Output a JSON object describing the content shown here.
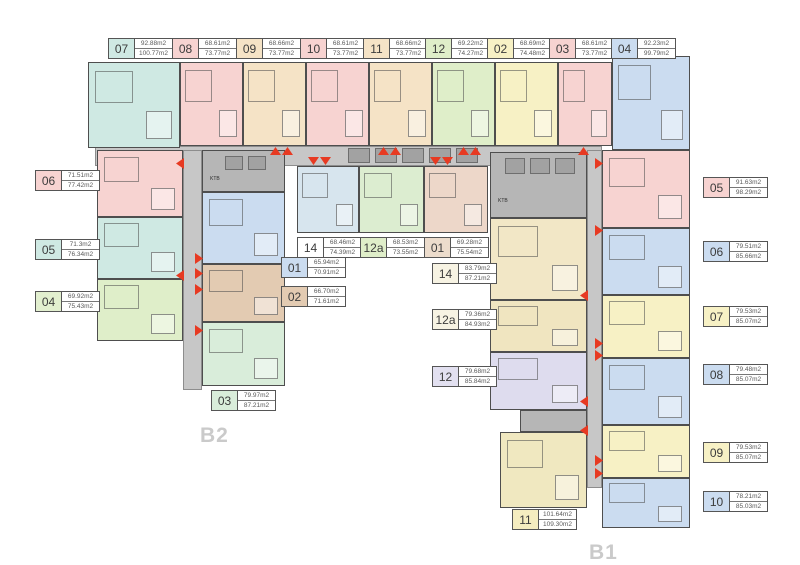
{
  "colors": {
    "teal": "#cfe9e3",
    "pink": "#f7d3d1",
    "tan": "#f5e3c6",
    "green": "#dfeec9",
    "yellow": "#f7f1c5",
    "blue": "#cbdcf0",
    "mint": "#d9edda",
    "lightblue": "#d7e5ee",
    "mintgreen": "#dcedd0",
    "cream": "#f2e7c6",
    "cream2": "#f0e5c0",
    "lavender": "#dedcee",
    "browntan": "#e3cbb2",
    "rosetan": "#edd7c9",
    "yellowtan": "#f0e8c0",
    "corridor": "#c7c7c7",
    "utility": "#b6b6b6",
    "red": "#e73a22"
  },
  "buildings": {
    "left": "B2",
    "right": "B1"
  },
  "utility_label": "KTB",
  "top_labels": [
    {
      "num": "07",
      "area1": "92.88m2",
      "area2": "100.77m2",
      "color": "#cfe9e3"
    },
    {
      "num": "08",
      "area1": "68.61m2",
      "area2": "73.77m2",
      "color": "#f7d3d1"
    },
    {
      "num": "09",
      "area1": "68.66m2",
      "area2": "73.77m2",
      "color": "#f5e3c6"
    },
    {
      "num": "10",
      "area1": "68.61m2",
      "area2": "73.77m2",
      "color": "#f7d3d1"
    },
    {
      "num": "11",
      "area1": "68.66m2",
      "area2": "73.77m2",
      "color": "#f5e3c6"
    },
    {
      "num": "12",
      "area1": "69.22m2",
      "area2": "74.27m2",
      "color": "#dfeec9"
    },
    {
      "num": "02",
      "area1": "68.69m2",
      "area2": "74.48m2",
      "color": "#f7f1c5"
    },
    {
      "num": "03",
      "area1": "68.61m2",
      "area2": "73.77m2",
      "color": "#f7d3d1"
    },
    {
      "num": "04",
      "area1": "92.23m2",
      "area2": "99.79m2",
      "color": "#cbdcf0"
    }
  ],
  "left_labels": [
    {
      "num": "06",
      "area1": "71.51m2",
      "area2": "77.42m2",
      "color": "#f7d3d1"
    },
    {
      "num": "05",
      "area1": "71.3m2",
      "area2": "76.34m2",
      "color": "#cfe9e3"
    },
    {
      "num": "04",
      "area1": "69.92m2",
      "area2": "75.43m2",
      "color": "#e2efcf"
    }
  ],
  "right_labels": [
    {
      "num": "05",
      "area1": "91.63m2",
      "area2": "98.29m2",
      "color": "#f7d3d1"
    },
    {
      "num": "06",
      "area1": "79.51m2",
      "area2": "85.66m2",
      "color": "#cbdcf0"
    },
    {
      "num": "07",
      "area1": "79.53m2",
      "area2": "85.07m2",
      "color": "#f7f1c5"
    },
    {
      "num": "08",
      "area1": "79.48m2",
      "area2": "85.07m2",
      "color": "#cbdcf0"
    },
    {
      "num": "09",
      "area1": "79.53m2",
      "area2": "85.07m2",
      "color": "#f7f1c5"
    },
    {
      "num": "10",
      "area1": "78.21m2",
      "area2": "85.03m2",
      "color": "#cbdcf0"
    }
  ],
  "mid_labels": [
    {
      "num": "14",
      "area1": "68.46m2",
      "area2": "74.39m2",
      "color": "#ffffff"
    },
    {
      "num": "12a",
      "area1": "68.53m2",
      "area2": "73.55m2",
      "color": "#dfeec9"
    },
    {
      "num": "01",
      "area1": "69.28m2",
      "area2": "75.54m2",
      "color": "#ecdccc"
    }
  ],
  "b2_labels": [
    {
      "num": "01",
      "area1": "65.94m2",
      "area2": "70.91m2",
      "color": "#cbdcf0"
    },
    {
      "num": "02",
      "area1": "66.70m2",
      "area2": "71.61m2",
      "color": "#e3cbb2"
    },
    {
      "num": "03",
      "area1": "79.97m2",
      "area2": "87.21m2",
      "color": "#d9edda"
    }
  ],
  "b1_labels": [
    {
      "num": "14",
      "area1": "83.79m2",
      "area2": "87.21m2",
      "color": "#f7f3e3"
    },
    {
      "num": "12a",
      "area1": "79.36m2",
      "area2": "84.93m2",
      "color": "#f7f3e3"
    },
    {
      "num": "12",
      "area1": "79.68m2",
      "area2": "85.84m2",
      "color": "#e2e0f0"
    },
    {
      "num": "11",
      "area1": "101.64m2",
      "area2": "109.30m2",
      "color": "#f5edc0"
    }
  ]
}
